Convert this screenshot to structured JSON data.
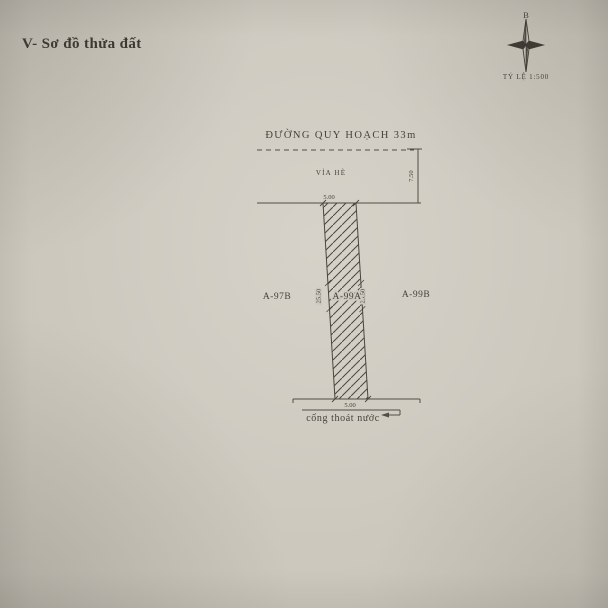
{
  "page_title": "V- Sơ đồ thửa đất",
  "compass": {
    "north": "B",
    "scale": "TỶ LỆ 1:500"
  },
  "diagram": {
    "road": "ĐƯỜNG QUY HOẠCH 33m",
    "sidewalk": "vỉa hè",
    "drain": "cống thoát nước",
    "parcels": {
      "left": "A-97B",
      "center": "A-99A",
      "right": "A-99B"
    },
    "dims": {
      "front_width": "5.00",
      "rear_width": "5.00",
      "left_depth": "25.50",
      "right_depth": "25.50",
      "sidewalk_depth": "7.50"
    }
  },
  "colors": {
    "paper": "#cdc9bf",
    "ink": "#46413b",
    "line": "#534d45"
  }
}
